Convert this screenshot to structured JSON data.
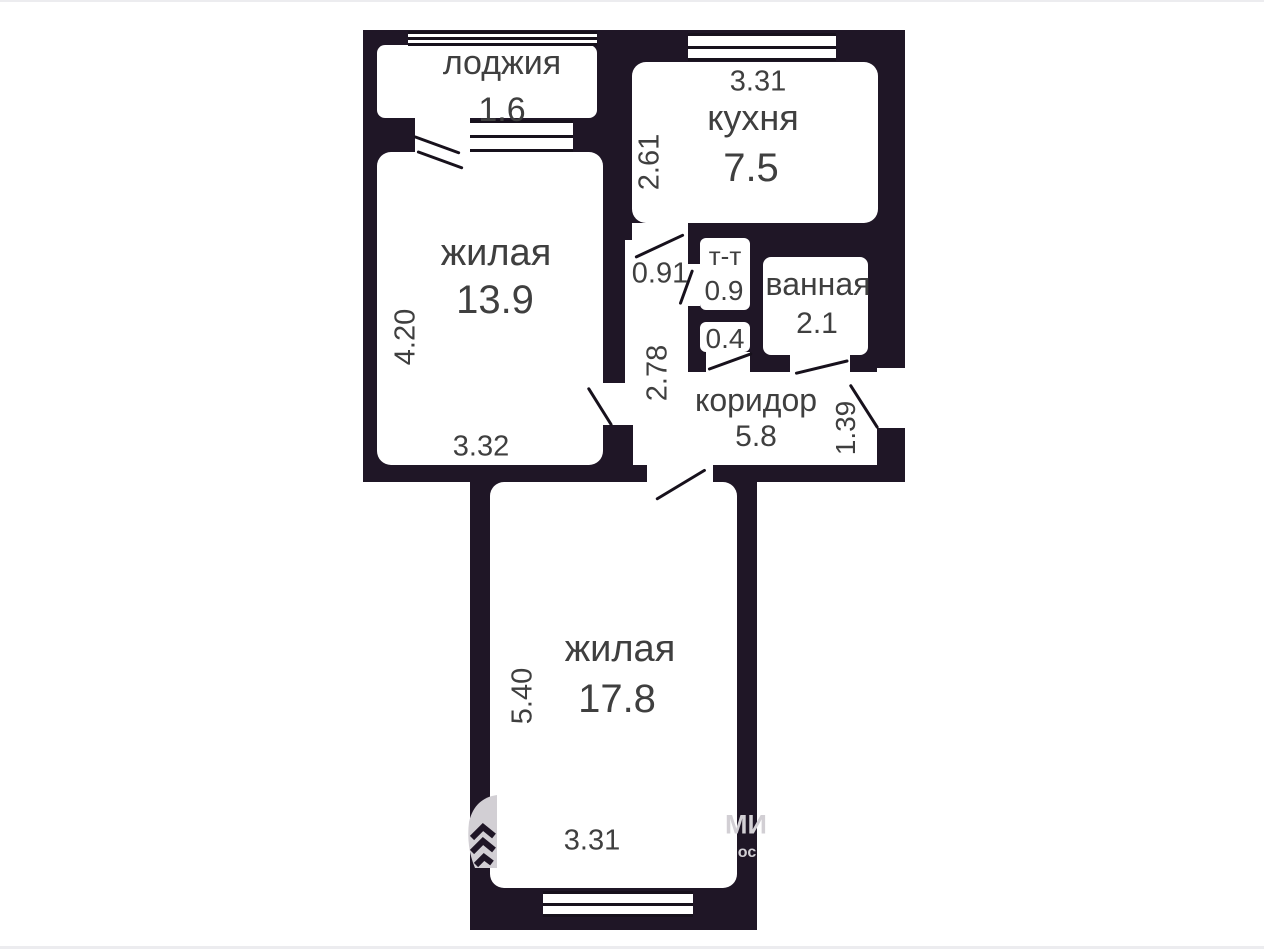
{
  "floorplan": {
    "wall_color": "#1f1626",
    "line_color": "#17111c",
    "text_color": "#3f3f3f",
    "watermark_color": "#d2cfd4",
    "rooms": {
      "loggia": {
        "label": "лоджия",
        "area": "1.6"
      },
      "kitchen": {
        "label": "кухня",
        "area": "7.5",
        "dim_top": "3.31",
        "dim_side": "2.61"
      },
      "living1": {
        "label": "жилая",
        "area": "13.9",
        "dim_side": "4.20",
        "dim_bottom": "3.32"
      },
      "hallway": {
        "dim_width": "0.91",
        "dim_side": "2.78"
      },
      "toilet": {
        "label": "т-т",
        "area": "0.9"
      },
      "storage": {
        "area": "0.4"
      },
      "bathroom": {
        "label": "ванная",
        "area": "2.1"
      },
      "corridor": {
        "label": "коридор",
        "area": "5.8",
        "dim_entry": "1.39"
      },
      "living2": {
        "label": "жилая",
        "area": "17.8",
        "dim_side": "5.40",
        "dim_bottom": "3.31"
      }
    },
    "watermark": {
      "logo": "house-chevrons",
      "text_line1": "МИ",
      "text_line2": "ос"
    }
  }
}
